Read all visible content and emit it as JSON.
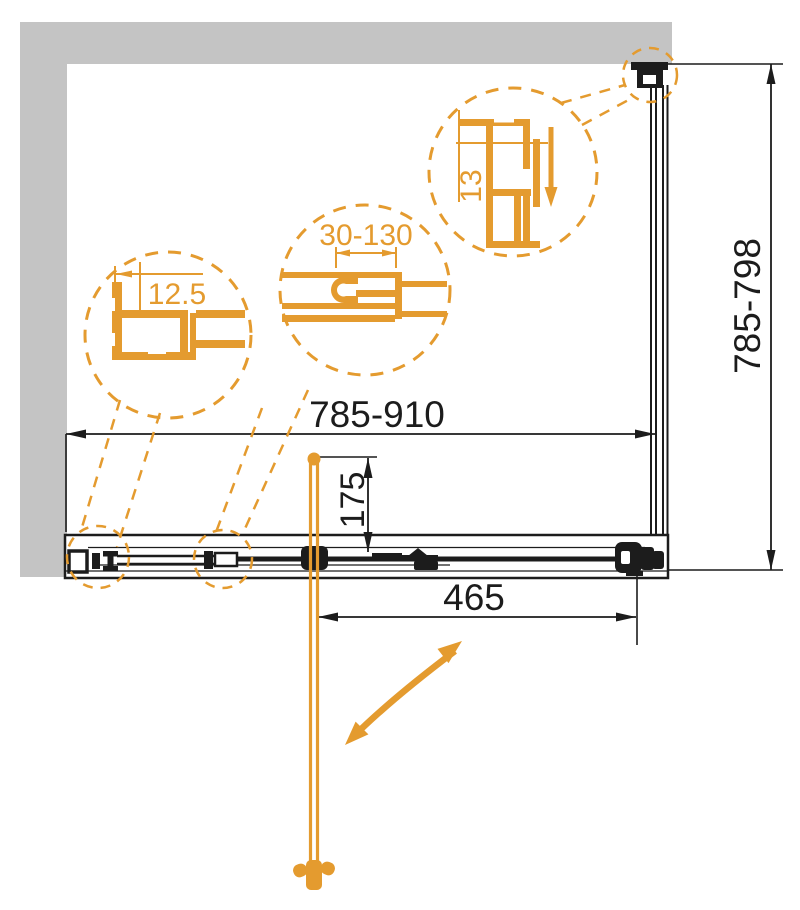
{
  "diagram": {
    "subject": "Shower door technical dimension drawing",
    "view": "front elevation with detail callouts",
    "dimension_labels": {
      "overall_width": "785-910",
      "overall_height": "785-798",
      "door_panel_width": "465",
      "handle_offset": "175"
    },
    "detail_callouts": {
      "wall_profile_width": "12.5",
      "adjustment_range": "30-130",
      "profile_depth": "13"
    },
    "colors": {
      "accent_orange": "#E49B2F",
      "wall_gray": "#C4C4C4",
      "line_black": "#1C1C1C",
      "background": "#FFFFFF"
    }
  }
}
